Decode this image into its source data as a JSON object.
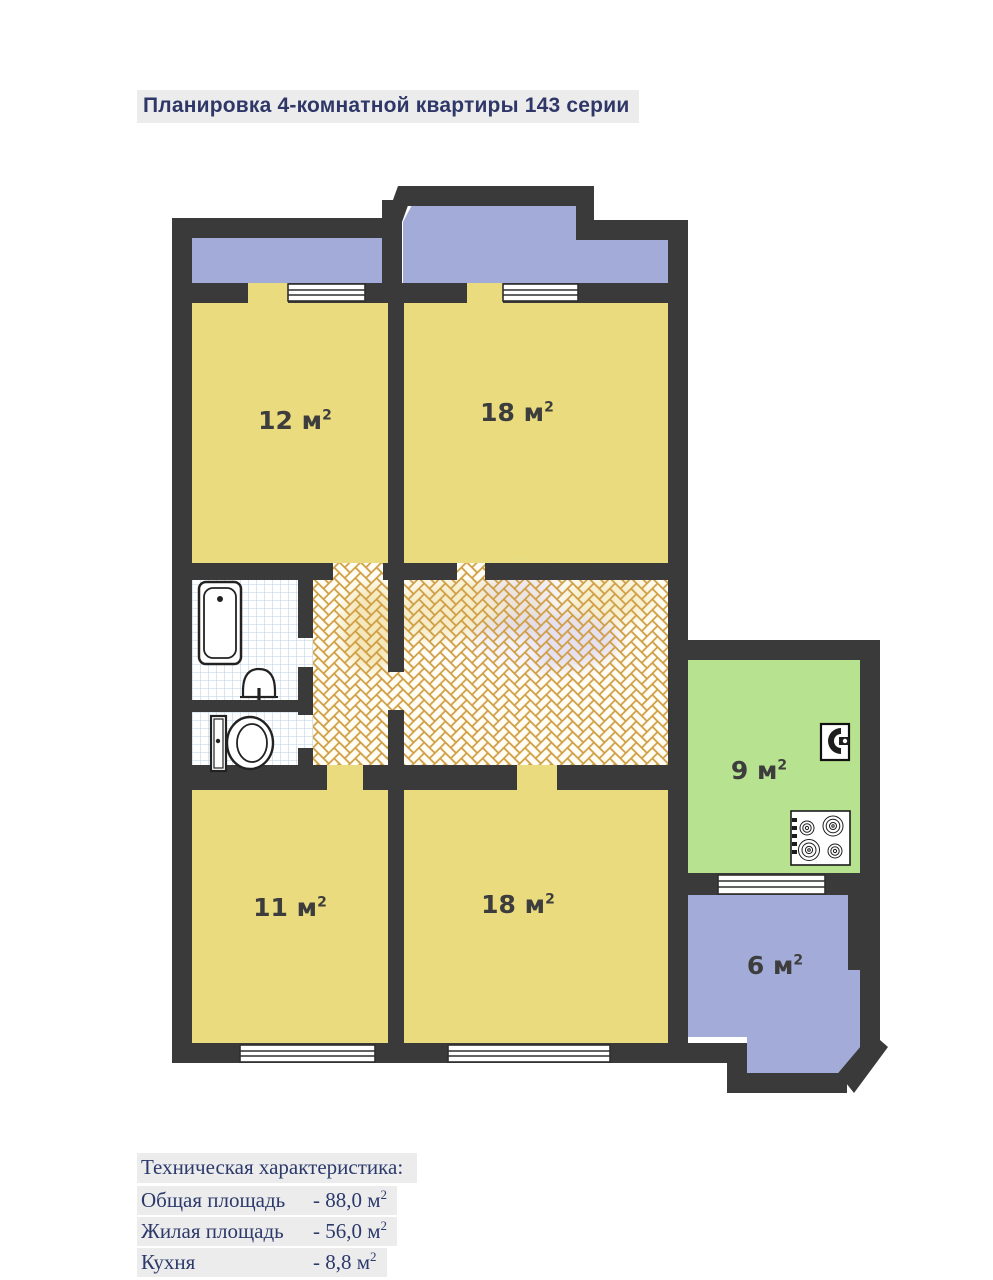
{
  "title": "Планировка 4-комнатной квартиры 143 серии",
  "rooms": [
    {
      "name": "living-room-12",
      "area": "12 м",
      "sup": "2"
    },
    {
      "name": "living-room-18-top",
      "area": "18 м",
      "sup": "2"
    },
    {
      "name": "living-room-11",
      "area": "11 м",
      "sup": "2"
    },
    {
      "name": "living-room-18-bottom",
      "area": "18 м",
      "sup": "2"
    },
    {
      "name": "kitchen",
      "area": "9 м",
      "sup": "2"
    },
    {
      "name": "balcony",
      "area": "6 м",
      "sup": "2"
    }
  ],
  "specs": {
    "heading": "Техническая характеристика:",
    "rows": [
      {
        "label": "Общая площадь",
        "value": "- 88,0 м",
        "sup": "2"
      },
      {
        "label": "Жилая площадь",
        "value": "- 56,0 м",
        "sup": "2"
      },
      {
        "label": "Кухня",
        "value": "- 8,8 м",
        "sup": "2"
      }
    ]
  },
  "colors": {
    "wall": "#3a3a3a",
    "room_yellow": "#e9db7e",
    "balcony_blue": "#a3abd8",
    "kitchen_green": "#b7e28f",
    "hall_base": "#fffdf4",
    "parquet_line": "#cf9c40",
    "tile_line": "#b9cfe6",
    "label_text": "#3d3d3d",
    "heading_text": "#2f3768",
    "highlight_bg": "#ececec",
    "fixture_stroke": "#222222"
  }
}
